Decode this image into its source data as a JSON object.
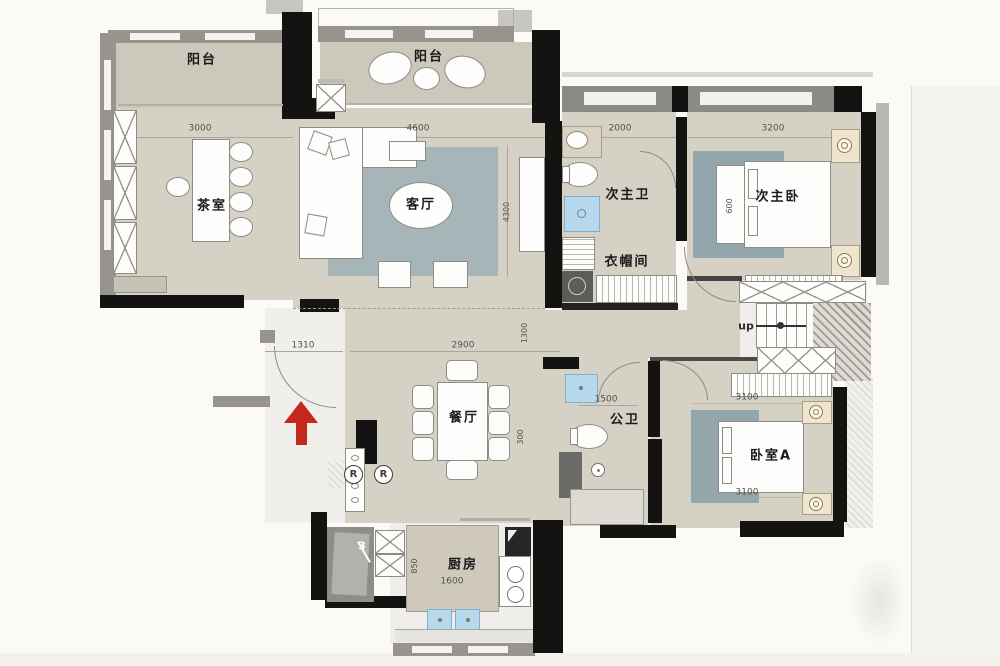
{
  "colors": {
    "wall": "#131312",
    "floor_beige": "#d6d1c5",
    "balcony_floor": "#ccc8bb",
    "rug_blue_gray": "#a6b5b8",
    "water_blue": "#b7d9ee",
    "entrance_arrow_red": "#c4271b",
    "exterior_band_gray": "#96948d"
  },
  "rooms": {
    "balcony_left": "阳台",
    "balcony_center": "阳台",
    "tea_room": "茶室",
    "living_room": "客厅",
    "dining_room": "餐厅",
    "kitchen": "厨房",
    "second_master_bath": "次主卫",
    "cloak_room": "衣帽间",
    "second_master_bedroom": "次主卧",
    "public_bath": "公卫",
    "bedroom_a": "卧室A"
  },
  "dims": {
    "d3000": "3000",
    "d4600": "4600",
    "d2000": "2000",
    "d3200": "3200",
    "d1310": "1310",
    "d2900": "2900",
    "d1500": "1500",
    "d3100a": "3100",
    "d3100b": "3100",
    "d1600": "1600",
    "d4300": "4300",
    "d1300": "1300",
    "d300": "300",
    "d850": "850",
    "d600": "600"
  },
  "annotations": {
    "stairs_up": "up",
    "stair_count": "3",
    "outlet": "R"
  }
}
